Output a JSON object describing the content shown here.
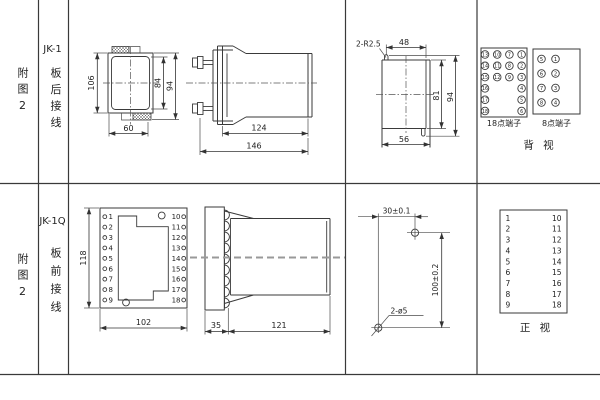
{
  "page": {
    "background": "#ffffff",
    "line_color": "#3a3a3a"
  },
  "header": {
    "row1": {
      "fig_no": "附图2",
      "model": "JK-1",
      "wiring": "板后接线"
    },
    "row2": {
      "fig_no": "附图2",
      "model": "JK-1Q",
      "wiring": "板前接线"
    }
  },
  "rear_front_view": {
    "height_overall": "106",
    "height_inner": "84",
    "height_outer": "94",
    "width_bottom": "60"
  },
  "rear_side_view": {
    "length_body": "124",
    "length_overall": "146"
  },
  "panel_cutout": {
    "radius_note": "2-R2.5",
    "width_top": "48",
    "height_inner": "81",
    "height_overall": "94",
    "width_bottom": "56"
  },
  "rear_terminals": {
    "block18_label": "18点端子",
    "block8_label": "8点端子",
    "view_label": "背 视",
    "block18_grid": [
      [
        "13",
        "10",
        "7",
        "1"
      ],
      [
        "14",
        "11",
        "8",
        "2"
      ],
      [
        "15",
        "12",
        "9",
        "3"
      ],
      [
        "16",
        "",
        "",
        "4"
      ],
      [
        "17",
        "",
        "",
        "5"
      ],
      [
        "18",
        "",
        "",
        "6"
      ]
    ],
    "block8_grid": [
      [
        "5",
        "1"
      ],
      [
        "6",
        "2"
      ],
      [
        "7",
        "3"
      ],
      [
        "8",
        "4"
      ]
    ]
  },
  "front_front_view": {
    "height_overall": "118",
    "width_bottom": "102",
    "left_terminals": [
      "1",
      "2",
      "3",
      "4",
      "5",
      "6",
      "7",
      "8",
      "9"
    ],
    "right_terminals": [
      "10",
      "11",
      "12",
      "13",
      "14",
      "15",
      "16",
      "17",
      "18"
    ]
  },
  "front_side_view": {
    "depth_panel": "35",
    "length_body": "121"
  },
  "drilling_plan": {
    "hole_spacing_x": "30±0.1",
    "hole_spacing_y": "100±0.2",
    "holes_note": "2-ø5"
  },
  "front_terminals": {
    "left": [
      "1",
      "2",
      "3",
      "4",
      "5",
      "6",
      "7",
      "8",
      "9"
    ],
    "right": [
      "10",
      "11",
      "12",
      "13",
      "14",
      "15",
      "16",
      "17",
      "18"
    ],
    "view_label": "正 视"
  }
}
